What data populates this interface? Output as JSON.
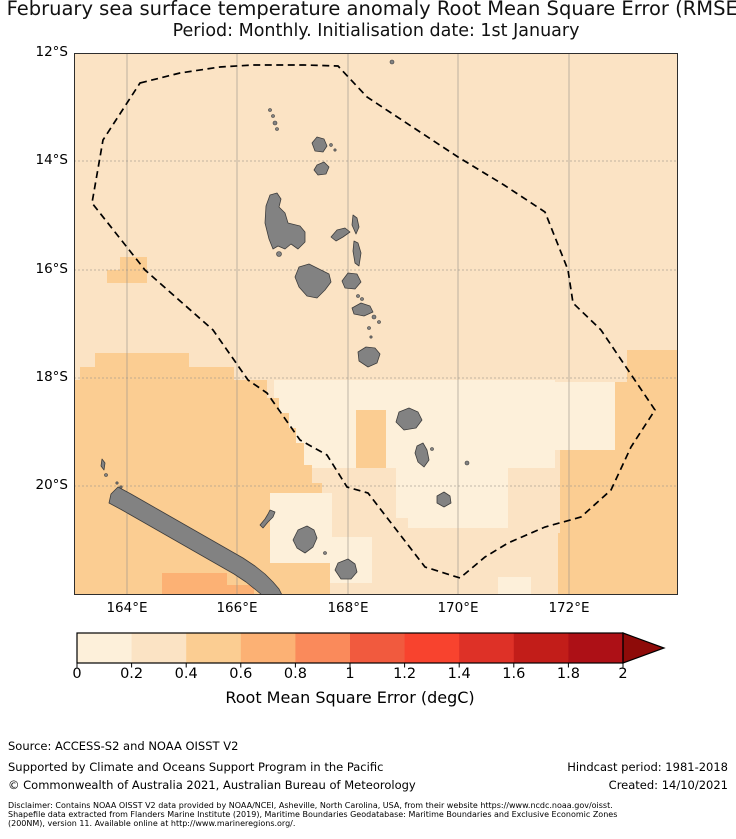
{
  "title": {
    "line1": "February sea surface temperature anomaly Root Mean Square Error (RMSE)",
    "line2": "Period: Monthly. Initialisation date: 1st January"
  },
  "map": {
    "width": 604,
    "height": 542,
    "lat_labels": [
      {
        "text": "12°S",
        "y": 0
      },
      {
        "text": "14°S",
        "y": 108
      },
      {
        "text": "16°S",
        "y": 217
      },
      {
        "text": "18°S",
        "y": 325
      },
      {
        "text": "20°S",
        "y": 433
      }
    ],
    "lon_labels": [
      {
        "text": "164°E",
        "x": 53
      },
      {
        "text": "166°E",
        "x": 163
      },
      {
        "text": "168°E",
        "x": 274
      },
      {
        "text": "170°E",
        "x": 384
      },
      {
        "text": "172°E",
        "x": 495
      }
    ],
    "grid": {
      "lat_y": [
        108,
        217,
        325,
        433
      ],
      "lon_x": [
        53,
        163,
        274,
        384,
        495
      ],
      "color": "#9a938b"
    },
    "ocean_bin": 1,
    "island_color": "#828282",
    "island_stroke": "#3d3d3d",
    "eez_color": "#000000",
    "patches": [
      {
        "bin": 0,
        "rect": [
          200,
          327,
          281,
          88
        ]
      },
      {
        "bin": 0,
        "rect": [
          480,
          329,
          61,
          68
        ]
      },
      {
        "bin": 0,
        "rect": [
          322,
          405,
          24,
          60
        ]
      },
      {
        "bin": 0,
        "rect": [
          334,
          415,
          100,
          60
        ]
      },
      {
        "bin": 0,
        "rect": [
          196,
          440,
          62,
          70
        ]
      },
      {
        "bin": 0,
        "rect": [
          256,
          484,
          42,
          46
        ]
      },
      {
        "bin": 0,
        "rect": [
          424,
          524,
          33,
          18
        ]
      },
      {
        "bin": 2,
        "poly": [
          [
            0,
            327
          ],
          [
            6,
            327
          ],
          [
            6,
            314
          ],
          [
            21,
            314
          ],
          [
            21,
            300
          ],
          [
            115,
            300
          ],
          [
            115,
            314
          ],
          [
            160,
            314
          ],
          [
            160,
            327
          ],
          [
            193,
            327
          ],
          [
            193,
            345
          ],
          [
            205,
            345
          ],
          [
            205,
            360
          ],
          [
            215,
            360
          ],
          [
            215,
            375
          ],
          [
            222,
            375
          ],
          [
            222,
            390
          ],
          [
            230,
            390
          ],
          [
            230,
            412
          ],
          [
            238,
            412
          ],
          [
            238,
            430
          ],
          [
            248,
            430
          ],
          [
            248,
            440
          ],
          [
            196,
            440
          ],
          [
            196,
            510
          ],
          [
            256,
            510
          ],
          [
            256,
            542
          ],
          [
            0,
            542
          ]
        ]
      },
      {
        "bin": 2,
        "rect": [
          46,
          204,
          27,
          13
        ]
      },
      {
        "bin": 2,
        "rect": [
          33,
          217,
          40,
          13
        ]
      },
      {
        "bin": 2,
        "rect": [
          282,
          357,
          30,
          58
        ]
      },
      {
        "bin": 2,
        "poly": [
          [
            553,
            297
          ],
          [
            604,
            297
          ],
          [
            604,
            542
          ],
          [
            484,
            542
          ],
          [
            484,
            480
          ],
          [
            486,
            480
          ],
          [
            486,
            397
          ],
          [
            541,
            397
          ],
          [
            541,
            329
          ],
          [
            553,
            329
          ]
        ]
      },
      {
        "bin": 3,
        "rect": [
          88,
          520,
          65,
          22
        ]
      },
      {
        "bin": 3,
        "rect": [
          153,
          532,
          27,
          10
        ]
      }
    ],
    "eez_boundary": [
      [
        66,
        30
      ],
      [
        106,
        20
      ],
      [
        146,
        14
      ],
      [
        179,
        12
      ],
      [
        230,
        12
      ],
      [
        264,
        13
      ],
      [
        293,
        44
      ],
      [
        384,
        104
      ],
      [
        430,
        132
      ],
      [
        471,
        159
      ],
      [
        494,
        217
      ],
      [
        499,
        250
      ],
      [
        527,
        277
      ],
      [
        581,
        357
      ],
      [
        557,
        394
      ],
      [
        537,
        437
      ],
      [
        507,
        464
      ],
      [
        471,
        474
      ],
      [
        434,
        490
      ],
      [
        411,
        504
      ],
      [
        386,
        525
      ],
      [
        351,
        514
      ],
      [
        294,
        440
      ],
      [
        273,
        434
      ],
      [
        253,
        402
      ],
      [
        226,
        387
      ],
      [
        193,
        340
      ],
      [
        174,
        327
      ],
      [
        139,
        277
      ],
      [
        71,
        217
      ],
      [
        18,
        150
      ],
      [
        29,
        87
      ]
    ],
    "islands": [
      {
        "name": "ureparapara",
        "dot": [
          318,
          9,
          2
        ]
      },
      {
        "name": "torres-1",
        "dot": [
          196,
          57,
          1.5
        ]
      },
      {
        "name": "torres-2",
        "dot": [
          199,
          63,
          1.5
        ]
      },
      {
        "name": "torres-3",
        "dot": [
          201,
          70,
          2
        ]
      },
      {
        "name": "torres-4",
        "dot": [
          203,
          76,
          1.5
        ]
      },
      {
        "name": "vanua-lava",
        "poly": [
          [
            238,
            90
          ],
          [
            243,
            84
          ],
          [
            250,
            86
          ],
          [
            253,
            93
          ],
          [
            249,
            99
          ],
          [
            241,
            98
          ]
        ]
      },
      {
        "name": "mota-lava",
        "dot": [
          257,
          92,
          1.4
        ]
      },
      {
        "name": "mota",
        "dot": [
          261,
          97,
          1.2
        ]
      },
      {
        "name": "gaua",
        "poly": [
          [
            243,
            112
          ],
          [
            250,
            109
          ],
          [
            255,
            114
          ],
          [
            252,
            121
          ],
          [
            244,
            122
          ],
          [
            240,
            117
          ]
        ]
      },
      {
        "name": "espiritu-santo",
        "poly": [
          [
            196,
            142
          ],
          [
            203,
            140
          ],
          [
            207,
            146
          ],
          [
            205,
            154
          ],
          [
            211,
            160
          ],
          [
            214,
            170
          ],
          [
            226,
            173
          ],
          [
            231,
            179
          ],
          [
            231,
            189
          ],
          [
            224,
            196
          ],
          [
            217,
            191
          ],
          [
            211,
            196
          ],
          [
            204,
            193
          ],
          [
            199,
            196
          ],
          [
            195,
            186
          ],
          [
            191,
            170
          ],
          [
            192,
            153
          ]
        ]
      },
      {
        "name": "malo",
        "dot": [
          205,
          201,
          2.5
        ]
      },
      {
        "name": "ambae",
        "poly": [
          [
            257,
            184
          ],
          [
            263,
            177
          ],
          [
            271,
            175
          ],
          [
            276,
            179
          ],
          [
            269,
            184
          ],
          [
            262,
            188
          ]
        ]
      },
      {
        "name": "maewo",
        "poly": [
          [
            279,
            162
          ],
          [
            283,
            165
          ],
          [
            285,
            174
          ],
          [
            282,
            181
          ],
          [
            278,
            172
          ]
        ]
      },
      {
        "name": "pentecost",
        "poly": [
          [
            280,
            188
          ],
          [
            284,
            190
          ],
          [
            287,
            200
          ],
          [
            285,
            213
          ],
          [
            281,
            210
          ],
          [
            279,
            198
          ]
        ]
      },
      {
        "name": "malakula",
        "poly": [
          [
            225,
            214
          ],
          [
            235,
            211
          ],
          [
            245,
            216
          ],
          [
            255,
            221
          ],
          [
            257,
            229
          ],
          [
            251,
            237
          ],
          [
            243,
            245
          ],
          [
            233,
            243
          ],
          [
            225,
            234
          ],
          [
            221,
            224
          ]
        ]
      },
      {
        "name": "ambrym",
        "poly": [
          [
            268,
            228
          ],
          [
            274,
            220
          ],
          [
            283,
            221
          ],
          [
            287,
            229
          ],
          [
            281,
            236
          ],
          [
            271,
            235
          ]
        ]
      },
      {
        "name": "paama",
        "dot": [
          284,
          243,
          1.5
        ]
      },
      {
        "name": "lopevi",
        "dot": [
          288,
          246,
          1.5
        ]
      },
      {
        "name": "epi",
        "poly": [
          [
            278,
            255
          ],
          [
            287,
            250
          ],
          [
            296,
            253
          ],
          [
            299,
            259
          ],
          [
            290,
            263
          ],
          [
            280,
            261
          ]
        ]
      },
      {
        "name": "tongoa",
        "dot": [
          300,
          264,
          2
        ]
      },
      {
        "name": "shepherd-2",
        "dot": [
          305,
          269,
          1.5
        ]
      },
      {
        "name": "shepherd-3",
        "dot": [
          295,
          275,
          1.5
        ]
      },
      {
        "name": "shepherd-4",
        "dot": [
          297,
          284,
          1.2
        ]
      },
      {
        "name": "efate",
        "poly": [
          [
            284,
            299
          ],
          [
            292,
            294
          ],
          [
            301,
            295
          ],
          [
            306,
            301
          ],
          [
            303,
            310
          ],
          [
            294,
            314
          ],
          [
            285,
            308
          ]
        ]
      },
      {
        "name": "erromango",
        "poly": [
          [
            325,
            359
          ],
          [
            335,
            355
          ],
          [
            344,
            359
          ],
          [
            348,
            367
          ],
          [
            342,
            375
          ],
          [
            330,
            377
          ],
          [
            322,
            369
          ]
        ]
      },
      {
        "name": "aniwa",
        "dot": [
          358,
          396,
          1.5
        ]
      },
      {
        "name": "tanna",
        "poly": [
          [
            343,
            393
          ],
          [
            349,
            390
          ],
          [
            353,
            397
          ],
          [
            355,
            407
          ],
          [
            350,
            414
          ],
          [
            344,
            409
          ],
          [
            341,
            400
          ]
        ]
      },
      {
        "name": "futuna",
        "dot": [
          393,
          410,
          2
        ]
      },
      {
        "name": "aneityum",
        "poly": [
          [
            363,
            443
          ],
          [
            370,
            439
          ],
          [
            376,
            443
          ],
          [
            377,
            450
          ],
          [
            370,
            454
          ],
          [
            363,
            450
          ]
        ]
      },
      {
        "name": "new-caledonia",
        "poly": [
          [
            44,
            434
          ],
          [
            57,
            441
          ],
          [
            71,
            449
          ],
          [
            85,
            457
          ],
          [
            99,
            465
          ],
          [
            113,
            473
          ],
          [
            127,
            481
          ],
          [
            141,
            489
          ],
          [
            155,
            497
          ],
          [
            169,
            505
          ],
          [
            181,
            513
          ],
          [
            191,
            521
          ],
          [
            199,
            529
          ],
          [
            205,
            536
          ],
          [
            208,
            542
          ],
          [
            188,
            542
          ],
          [
            182,
            537
          ],
          [
            172,
            529
          ],
          [
            160,
            521
          ],
          [
            146,
            513
          ],
          [
            132,
            505
          ],
          [
            118,
            497
          ],
          [
            104,
            489
          ],
          [
            90,
            481
          ],
          [
            76,
            473
          ],
          [
            62,
            465
          ],
          [
            48,
            457
          ],
          [
            35,
            450
          ],
          [
            37,
            441
          ]
        ]
      },
      {
        "name": "belep",
        "poly": [
          [
            28,
            406
          ],
          [
            31,
            410
          ],
          [
            30,
            417
          ],
          [
            27,
            413
          ]
        ]
      },
      {
        "name": "belep-2",
        "dot": [
          32,
          422,
          1.5
        ]
      },
      {
        "name": "islet-1",
        "dot": [
          43,
          430,
          1.2
        ]
      },
      {
        "name": "islet-2",
        "dot": [
          47,
          434,
          1.2
        ]
      },
      {
        "name": "ouvea",
        "poly": [
          [
            196,
            457
          ],
          [
            201,
            459
          ],
          [
            199,
            464
          ],
          [
            194,
            469
          ],
          [
            189,
            475
          ],
          [
            186,
            472
          ],
          [
            191,
            466
          ],
          [
            194,
            461
          ]
        ]
      },
      {
        "name": "lifou",
        "poly": [
          [
            224,
            477
          ],
          [
            233,
            473
          ],
          [
            240,
            477
          ],
          [
            243,
            485
          ],
          [
            239,
            494
          ],
          [
            231,
            500
          ],
          [
            223,
            495
          ],
          [
            219,
            487
          ],
          [
            222,
            481
          ]
        ]
      },
      {
        "name": "tiga",
        "dot": [
          251,
          500,
          1.5
        ]
      },
      {
        "name": "mare",
        "poly": [
          [
            264,
            510
          ],
          [
            274,
            506
          ],
          [
            281,
            511
          ],
          [
            283,
            519
          ],
          [
            277,
            526
          ],
          [
            267,
            526
          ],
          [
            261,
            517
          ]
        ]
      }
    ]
  },
  "colorbar": {
    "bin_colors": [
      "#fdf0da",
      "#fbe3c4",
      "#fbcd92",
      "#fcb174",
      "#fa8a5b",
      "#f15a3e",
      "#f8432e",
      "#de3127",
      "#c21d19",
      "#ad1016"
    ],
    "arrow_color": "#8e0b09",
    "tick_labels": [
      "0",
      "0.2",
      "0.4",
      "0.6",
      "0.8",
      "1",
      "1.2",
      "1.4",
      "1.6",
      "1.8",
      "2"
    ],
    "label": "Root Mean Square Error (degC)",
    "range": [
      0,
      2
    ]
  },
  "footer": {
    "source": "Source: ACCESS-S2 and NOAA OISST V2",
    "supported": "Supported by Climate and Oceans Support Program in the Pacific",
    "copyright": "© Commonwealth of Australia 2021, Australian Bureau of Meteorology",
    "hindcast": "Hindcast period: 1981-2018",
    "created": "Created: 14/10/2021",
    "disclaimer_line1": "Disclaimer: Contains NOAA OISST V2 data provided by NOAA/NCEI, Asheville, North Carolina, USA, from their website https://www.ncdc.noaa.gov/oisst.",
    "disclaimer_line2": "Shapefile data extracted from Flanders Marine Institute (2019), Maritime Boundaries Geodatabase: Maritime Boundaries and Exclusive Economic Zones",
    "disclaimer_line3": "(200NM), version 11. Available online at http://www.marineregions.org/."
  }
}
